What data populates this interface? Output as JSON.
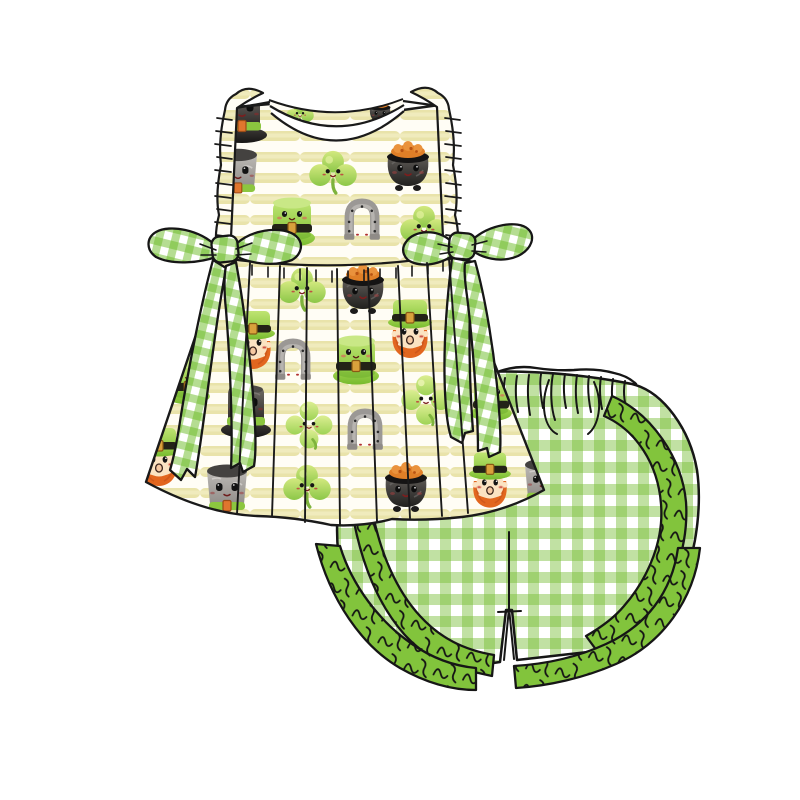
{
  "page": {
    "background_color": "#ffffff",
    "description": "Watercolor product illustration of a two-piece children's St. Patrick's Day outfit on a plain white background"
  },
  "outfit": {
    "top": {
      "label": "Sleeveless flutter-sleeve pleated tunic top in yellow watercolor stripe St. Patrick's print",
      "fabric": "cream and pale-yellow watercolor stripes",
      "bow_label": "Green gingham side bow with long tails",
      "trims": [
        "white round neckline binding",
        "gathered ruffle armhole edges",
        "green gingham side bows",
        "gathered pleated skirt with wavy hem"
      ],
      "motifs": [
        "green leprechaun top hat with smiling face",
        "black top hat with face and green band",
        "gray top hat with face and green band",
        "smiling shamrock",
        "smiling four-leaf clover",
        "gray horseshoe with nail dots",
        "black pot of gold with face and orange coins",
        "leprechaun face with green hat and orange beard"
      ]
    },
    "shorts": {
      "label": "Green gingham shorts with curved double ruffle trim",
      "fabric": "green and white gingham check",
      "trims": [
        "gathered elastic waistband with stitch marks",
        "curved green ruffle side panels",
        "green ruffled hems",
        "center front seam with hem notch"
      ]
    },
    "colors": {
      "stripe_yellow": "#e9e3aa",
      "gingham_green": "#76bc32",
      "ruffle_green": "#82c43c",
      "hat_green": "#8fce44",
      "coin_orange": "#e07f27",
      "beard_orange": "#e2661f",
      "pot_black": "#262422",
      "horseshoe_gray": "#9b9895",
      "outline_black": "#1a1a1a",
      "skin_tan": "#fbe3c2",
      "neck_binding": "#ffffff"
    }
  }
}
